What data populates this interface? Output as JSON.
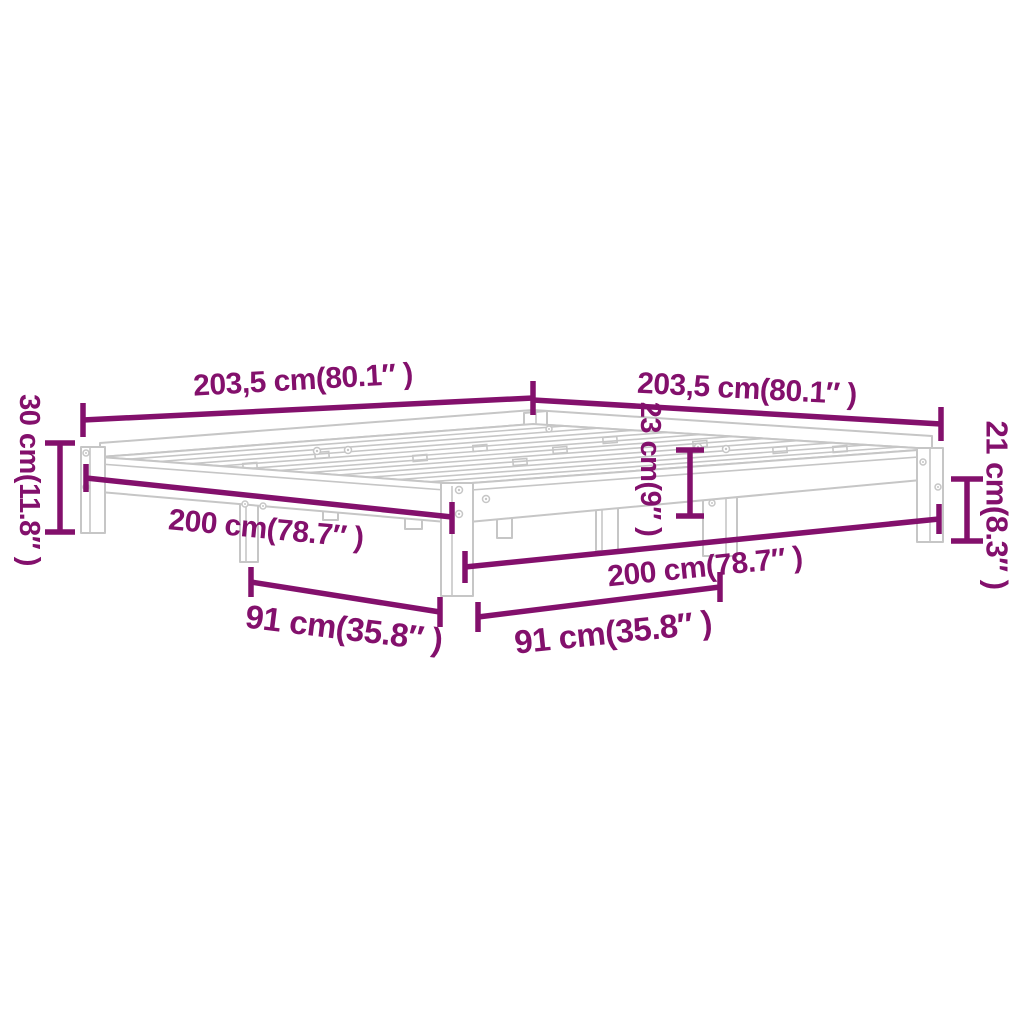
{
  "figure": {
    "type": "product-dimension-diagram",
    "subject": "bed-frame-perspective-line-drawing"
  },
  "colors": {
    "dimension": "#83106C",
    "drawing": "#c6c6c6",
    "background": "#ffffff"
  },
  "labels": {
    "total_length_left": "203,5 cm(80.1″ )",
    "total_length_right": "203,5 cm(80.1″ )",
    "height_left": "30 cm(11.8″ )",
    "height_middle": "23 cm(9″ )",
    "height_right": "21 cm(8.3″ )",
    "inner_length_left": "200 cm(78.7″ )",
    "inner_length_right": "200 cm(78.7″ )",
    "leg_span_left": "91 cm(35.8″ )",
    "leg_span_right": "91 cm(35.8″ )"
  }
}
